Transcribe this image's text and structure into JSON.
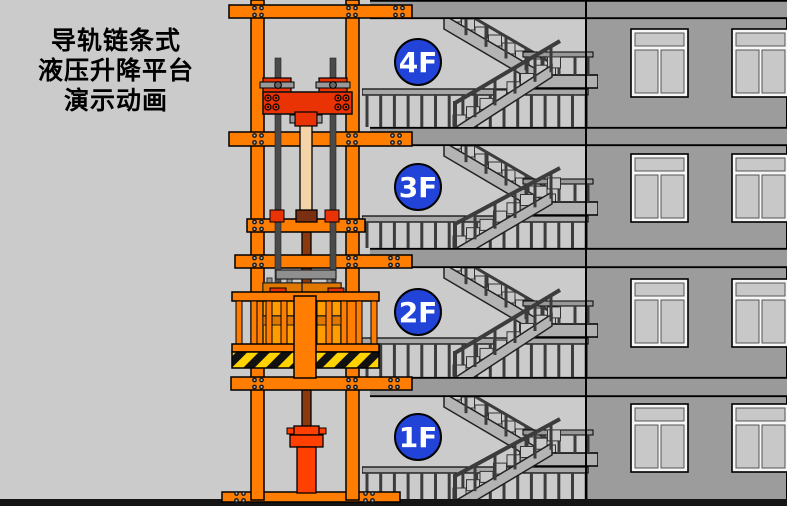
{
  "title": {
    "line1": "导轨链条式",
    "line2": "液压升降平台",
    "line3": "演示动画"
  },
  "floors": [
    {
      "label": "4F"
    },
    {
      "label": "3F"
    },
    {
      "label": "2F"
    },
    {
      "label": "1F"
    }
  ],
  "building": {
    "window_rows": 4,
    "windows_per_row": 2
  },
  "colors": {
    "background": "#cbcbcb",
    "tower_orange": "#ff7d00",
    "carriage_red": "#ea3305",
    "cylinder_red": "#ff4000",
    "piston_tan": "#f5d3a8",
    "rod_brown": "#8b3a10",
    "collar_brown": "#7a2f10",
    "cargo_orange": "#ff9d00",
    "cargo_lid": "#e07800",
    "hazard_yellow": "#ffd200",
    "hazard_black": "#111111",
    "badge_blue": "#2243d8",
    "badge_text": "#ffffff",
    "wall_gray": "#9c9c9c",
    "slab_gray": "#9a9a9a",
    "stair_gray": "#b4b4b4",
    "step_gray": "#c9c9c9",
    "rail_dark": "#3c3c3c",
    "chain_gray": "#4a4a4a",
    "ground_black": "#151515",
    "outline": "#000000"
  }
}
